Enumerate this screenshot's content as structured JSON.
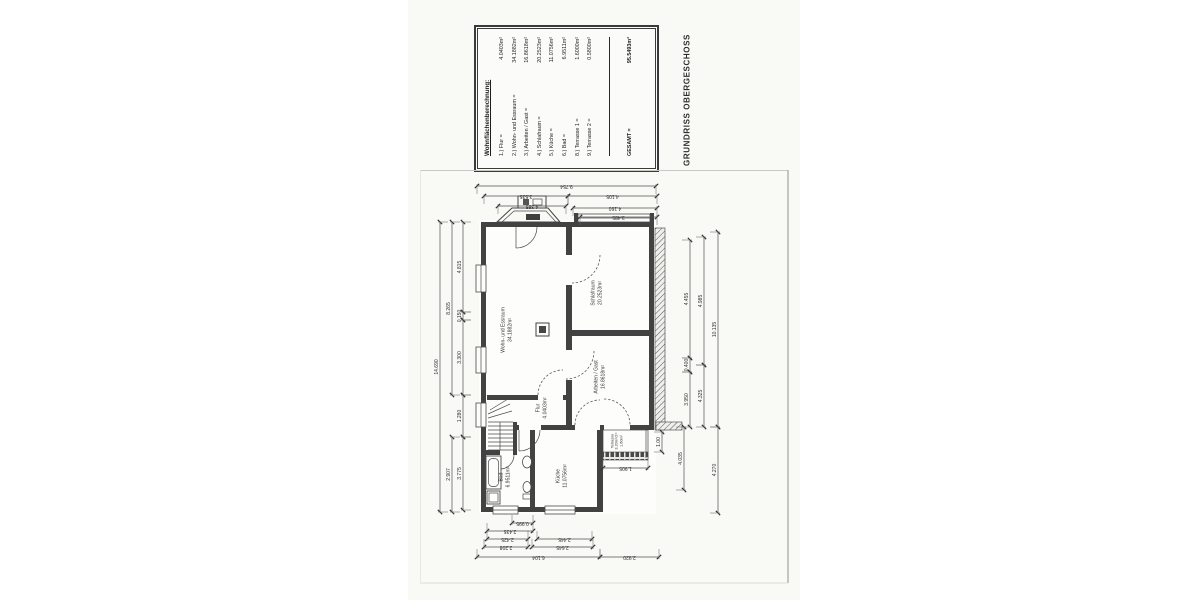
{
  "title": "GRUNDRISS OBERGESCHOSS",
  "area_table": {
    "heading": "Wohnflächenberechnung:",
    "rows": [
      {
        "label": "1.) Flur =",
        "value": "4.0403m²"
      },
      {
        "label": "2.) Wohn- und Essraum =",
        "value": "34.1882m²"
      },
      {
        "label": "3.) Arbeiten / Gast =",
        "value": "16.8618m²"
      },
      {
        "label": "4.) Schlafraum =",
        "value": "20.2523m²"
      },
      {
        "label": "5.) Küche =",
        "value": "11.0756m²"
      },
      {
        "label": "6.) Bad =",
        "value": "6.9511m²"
      },
      {
        "label": "8.) Terrasse 1 =",
        "value": "1.6000m²"
      },
      {
        "label": "9.) Terrasse 2 =",
        "value": "0.5800m²"
      }
    ],
    "total": {
      "label": "GESAMT =",
      "value": "95.5493m²"
    }
  },
  "plan": {
    "rooms": [
      {
        "x": 87,
        "y": 160,
        "lines": [
          "Wohn- und Essraum",
          "34.1882m²"
        ]
      },
      {
        "x": 177,
        "y": 123,
        "lines": [
          "Schlafraum",
          "20.2523m²"
        ]
      },
      {
        "x": 180,
        "y": 207,
        "lines": [
          "Arbeiten / Gast",
          "16.8618m²"
        ]
      },
      {
        "x": 122,
        "y": 238,
        "lines": [
          "Flur",
          "4.0403m²"
        ]
      },
      {
        "x": 142,
        "y": 306,
        "lines": [
          "Küche",
          "11.0756m²"
        ]
      },
      {
        "x": 85,
        "y": 307,
        "lines": [
          "Bad",
          "6.9511m²"
        ]
      },
      {
        "x": 197,
        "y": 271,
        "lines": [
          "Terrasse",
          "3.20m²/2=",
          "1.60m²"
        ],
        "small": true
      }
    ],
    "dims": [
      {
        "t": "h",
        "y": 16,
        "a": 57,
        "b": 236,
        "w": 1,
        "label": "9.754"
      },
      {
        "t": "h",
        "y": 26,
        "a": 64,
        "b": 148,
        "w": 1,
        "label": "3.535"
      },
      {
        "t": "h",
        "y": 26,
        "a": 148,
        "b": 237,
        "w": 1,
        "label": "4.105"
      },
      {
        "t": "h",
        "y": 36,
        "a": 78,
        "b": 146,
        "w": 1,
        "label": "4.385"
      },
      {
        "t": "h",
        "y": 38,
        "a": 153,
        "b": 237,
        "w": 1,
        "label": "4.160"
      },
      {
        "t": "h",
        "y": 47,
        "a": 160,
        "b": 237,
        "w": 1,
        "label": "3.485"
      },
      {
        "t": "h",
        "y": 353,
        "a": 92,
        "b": 113,
        "w": -1,
        "label": "0.995"
      },
      {
        "t": "h",
        "y": 361,
        "a": 67,
        "b": 113,
        "w": -1,
        "label": "2.435"
      },
      {
        "t": "h",
        "y": 369,
        "a": 67,
        "b": 108,
        "w": -1,
        "label": "2.425"
      },
      {
        "t": "h",
        "y": 369,
        "a": 117,
        "b": 172,
        "w": -1,
        "label": "2.445"
      },
      {
        "t": "h",
        "y": 377,
        "a": 64,
        "b": 108,
        "w": -1,
        "label": "2.208"
      },
      {
        "t": "h",
        "y": 377,
        "a": 112,
        "b": 173,
        "w": -1,
        "label": "2.645"
      },
      {
        "t": "h",
        "y": 387,
        "a": 57,
        "b": 180,
        "w": -1,
        "label": "6.104"
      },
      {
        "t": "h",
        "y": 387,
        "a": 180,
        "b": 239,
        "w": -1,
        "label": "2.920"
      },
      {
        "t": "h",
        "y": 298,
        "a": 183,
        "b": 228,
        "w": -1,
        "label": "1.905"
      },
      {
        "t": "v",
        "x": 20,
        "a": 52,
        "b": 342,
        "w": 1,
        "label": "14.690"
      },
      {
        "t": "v",
        "x": 32,
        "a": 52,
        "b": 225,
        "w": 1,
        "label": "8.265"
      },
      {
        "t": "v",
        "x": 32,
        "a": 267,
        "b": 342,
        "w": 1,
        "label": "2.907"
      },
      {
        "t": "v",
        "x": 43,
        "a": 52,
        "b": 142,
        "w": 1,
        "label": "4.815"
      },
      {
        "t": "v",
        "x": 43,
        "a": 142,
        "b": 150,
        "w": 1,
        "label": "0.150"
      },
      {
        "t": "v",
        "x": 43,
        "a": 150,
        "b": 225,
        "w": 1,
        "label": "3.300"
      },
      {
        "t": "v",
        "x": 43,
        "a": 225,
        "b": 267,
        "w": 1,
        "label": "1.280"
      },
      {
        "t": "v",
        "x": 43,
        "a": 267,
        "b": 340,
        "w": 1,
        "label": "3.775"
      },
      {
        "t": "v",
        "x": 270,
        "a": 70,
        "b": 188,
        "w": -1,
        "label": "4.455"
      },
      {
        "t": "v",
        "x": 270,
        "a": 188,
        "b": 202,
        "w": -1,
        "label": "0.400"
      },
      {
        "t": "v",
        "x": 270,
        "a": 202,
        "b": 257,
        "w": -1,
        "label": "3.950"
      },
      {
        "t": "v",
        "x": 264,
        "a": 257,
        "b": 320,
        "w": -1,
        "label": "4.035"
      },
      {
        "t": "v",
        "x": 284,
        "a": 67,
        "b": 195,
        "w": -1,
        "label": "4.985"
      },
      {
        "t": "v",
        "x": 284,
        "a": 195,
        "b": 257,
        "w": -1,
        "label": "4.325"
      },
      {
        "t": "v",
        "x": 298,
        "a": 62,
        "b": 257,
        "w": -1,
        "label": "10.135"
      },
      {
        "t": "v",
        "x": 298,
        "a": 257,
        "b": 343,
        "w": -1,
        "label": "4.270"
      },
      {
        "t": "v",
        "x": 242,
        "a": 262,
        "b": 282,
        "w": -1,
        "label": "1.00"
      }
    ]
  }
}
